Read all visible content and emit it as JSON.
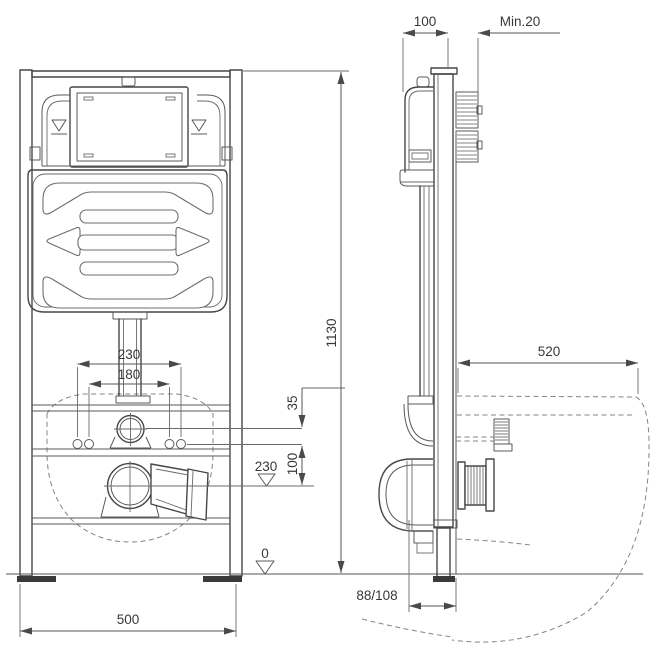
{
  "drawing": {
    "type": "installation-dimension-drawing",
    "subject": "concealed-wc-cistern-frame",
    "colors": {
      "line": "#474747",
      "dim_line": "#555555",
      "text": "#383838",
      "background": "#ffffff"
    }
  },
  "labels": {
    "side_frame_depth": "100",
    "side_min_clearance": "Min.20",
    "frame_height": "1130",
    "fixing_width_outer": "230",
    "fixing_width_inner": "180",
    "supply_offset": "35",
    "supply_to_drain": "100",
    "drain_axis_height": "230",
    "floor_level": "0",
    "frame_width": "500",
    "bowl_depth": "520",
    "drain_wall_distance": "88/108"
  }
}
